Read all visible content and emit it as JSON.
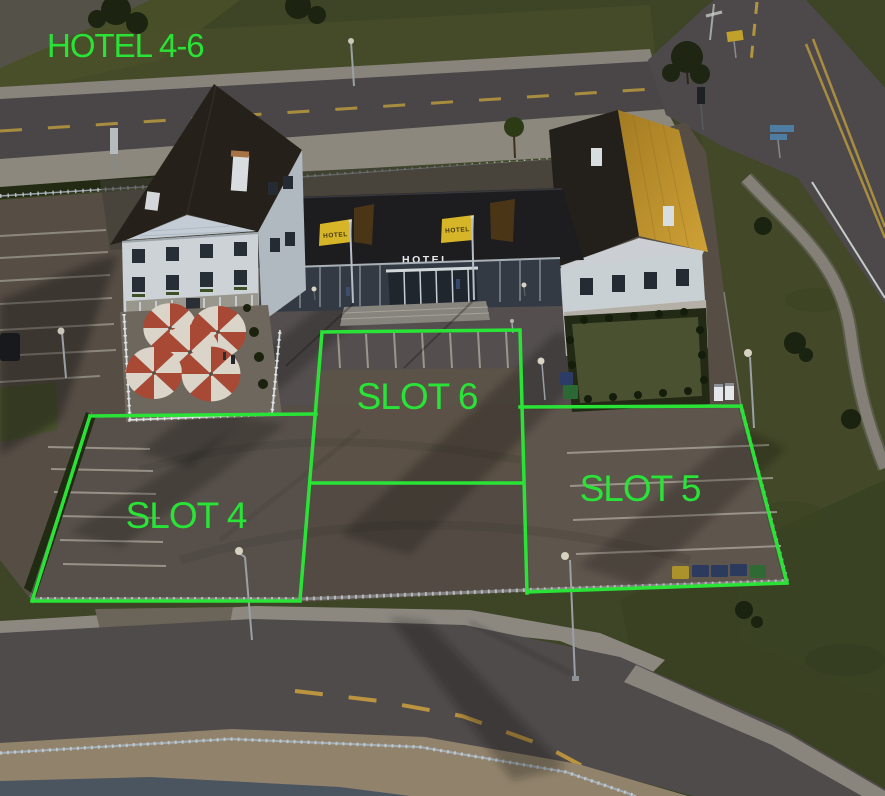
{
  "annotation": {
    "title": "HOTEL 4-6",
    "color": "#29e437",
    "slots": [
      {
        "label": "SLOT 4"
      },
      {
        "label": "SLOT 5"
      },
      {
        "label": "SLOT 6"
      }
    ]
  },
  "scene": {
    "hotel_entrance_sign": "HOTEL",
    "banner_left_text": "HOTEL",
    "banner_right_text": "HOTEL",
    "colors": {
      "overlay_green": "#29e437",
      "grass": "#3e4426",
      "asphalt": "#4b4748",
      "parking_lot": "#564e45",
      "left_roof_brown": "#26201a",
      "right_roof_gold": "#b8892c",
      "banner_yellow": "#d6b628",
      "umbrella_red": "#a84936",
      "road_marking_yellow": "#b2943e"
    }
  }
}
